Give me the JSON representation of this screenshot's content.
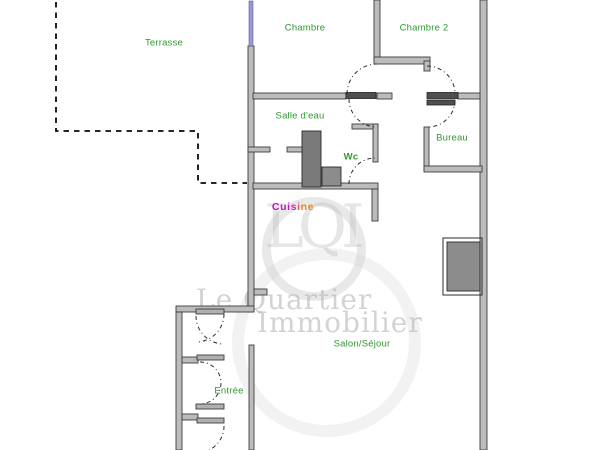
{
  "watermark": {
    "line1": "Le Quartier",
    "line2": "Immobilier",
    "monogram": "LQI"
  },
  "label_color": "#2f9a2f",
  "rooms": {
    "terrasse": {
      "label": "Terrasse"
    },
    "chambre": {
      "label": "Chambre"
    },
    "chambre2": {
      "label": "Chambre 2"
    },
    "salledeau": {
      "label": "Salle d'eau"
    },
    "wc": {
      "label": "Wc"
    },
    "bureau": {
      "label": "Bureau"
    },
    "cuisine": {
      "label": "Cuisine",
      "letter_colors": [
        "#c413c4",
        "#c413c4",
        "#c413c4",
        "#cf2e9e",
        "#d85c62",
        "#e0881e",
        "#e0881e"
      ]
    },
    "salon": {
      "label": "Salon/Séjour"
    },
    "entree": {
      "label": "Entrée"
    }
  },
  "plan_colors": {
    "wall_fill": "#bcbcbc",
    "wall_edge": "#3d3d3d",
    "window": "#9a9ad2",
    "fixture": "#8c8c8c",
    "terrace_dash": "#0a0a0a"
  }
}
